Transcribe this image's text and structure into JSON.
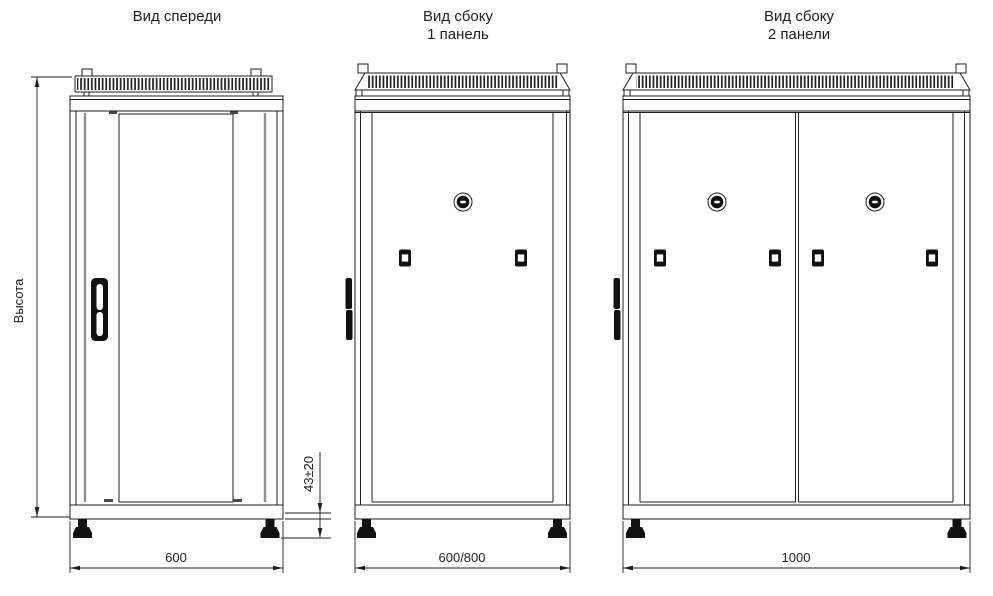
{
  "drawing": {
    "background": "#ffffff",
    "line_color": "#1f1f1f",
    "gray_line_color": "#8f8f8f",
    "fill_color": "#111111",
    "views": [
      {
        "name": "front",
        "title_lines": [
          "Вид спереди"
        ],
        "width_dim": "600"
      },
      {
        "name": "side-one-panel",
        "title_lines": [
          "Вид сбоку",
          "1 панель"
        ],
        "width_dim": "600/800"
      },
      {
        "name": "side-two-panels",
        "title_lines": [
          "Вид сбоку",
          "2 панели"
        ],
        "width_dim": "1000"
      }
    ],
    "height_label": "Высота",
    "foot_height_dim": "43±20"
  }
}
